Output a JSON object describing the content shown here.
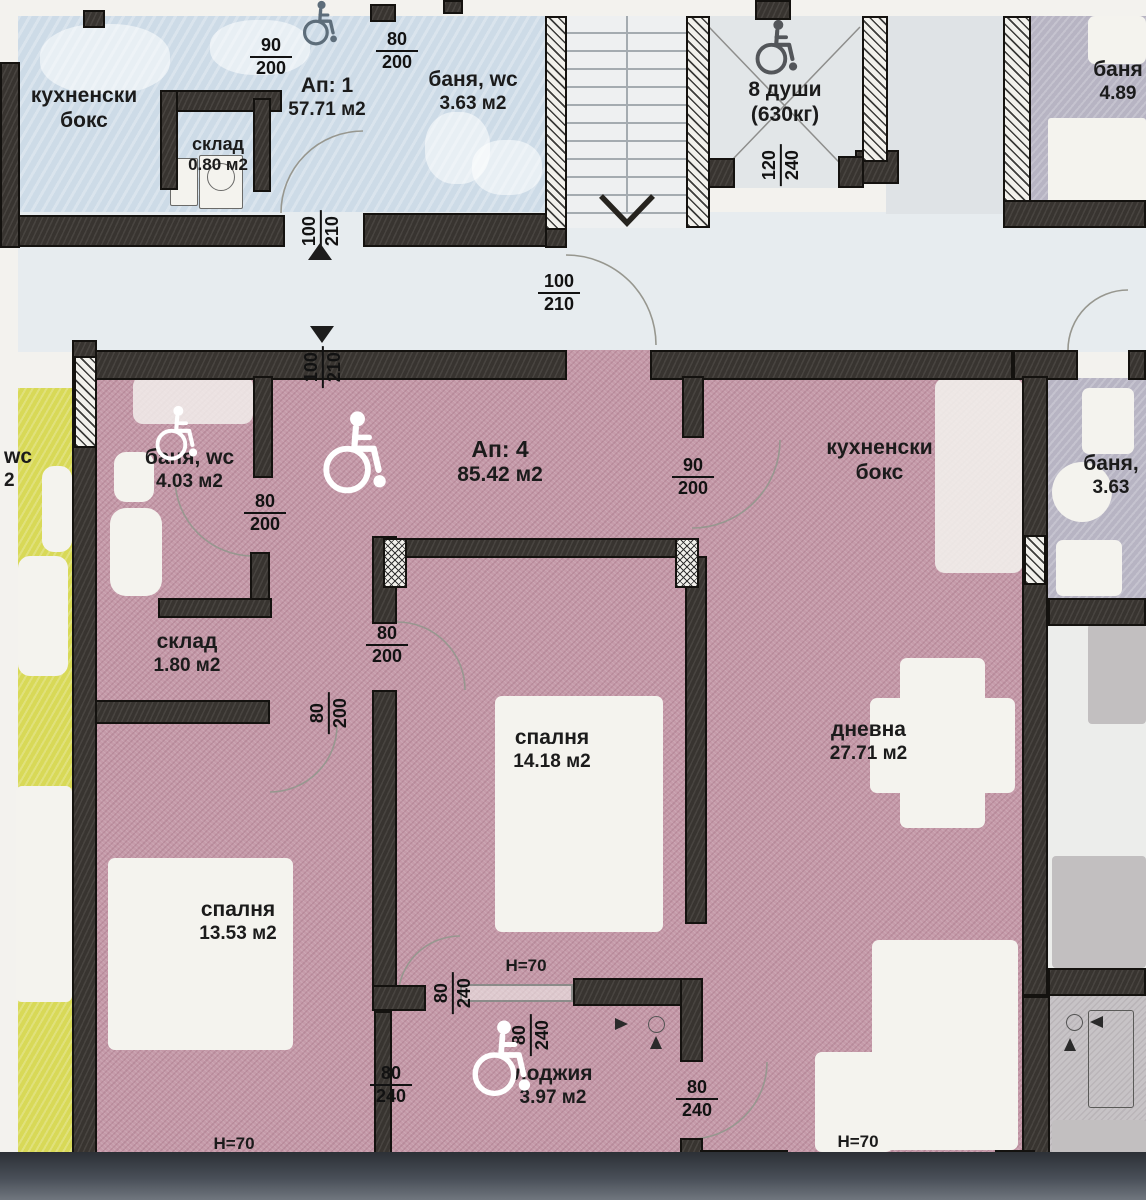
{
  "colors": {
    "apartment_pink": "#c59aa9",
    "walls_dark": "#33302c",
    "upper_blue": "#cddbe7",
    "adjacent_yellow": "#d8d957",
    "corridor_gray": "#e7ecef"
  },
  "upper": {
    "kitchen_label": "кухненски бокс",
    "ap1_title": "Ап: 1",
    "ap1_area": "57.71 м2",
    "storage_label": "склад",
    "storage_area": "0.80 м2",
    "bath_label": "баня, wc",
    "bath_area": "3.63 м2",
    "elevator_capacity": "8 души",
    "elevator_weight": "(630кг)",
    "bath_right_label": "баня",
    "bath_right_area": "4.89"
  },
  "ap4": {
    "title": "Ап: 4",
    "area": "85.42 м2",
    "bath_label": "баня, wc",
    "bath_area": "4.03 м2",
    "storage_label": "склад",
    "storage_area": "1.80 м2",
    "kitchen_label": "кухненски бокс",
    "bedroom1_label": "спалня",
    "bedroom1_area": "14.18 м2",
    "bedroom2_label": "спалня",
    "bedroom2_area": "13.53 м2",
    "living_label": "дневна",
    "living_area": "27.71 м2",
    "loggia_label": "лоджия",
    "loggia_area": "3.97 м2"
  },
  "right": {
    "bath_label": "баня,",
    "bath_area": "3.63"
  },
  "left": {
    "partial_wc": "wc",
    "partial_area": "2"
  },
  "annotations": {
    "parapet_height": "H=70"
  },
  "dims": {
    "d0": {
      "num": "90",
      "den": "200"
    },
    "d1": {
      "num": "80",
      "den": "200"
    },
    "d2": {
      "num": "100",
      "den": "210"
    },
    "d3": {
      "num": "100",
      "den": "210"
    },
    "d4": {
      "num": "100",
      "den": "210"
    },
    "d5": {
      "num": "120",
      "den": "240"
    },
    "d6": {
      "num": "80",
      "den": "200"
    },
    "d7": {
      "num": "90",
      "den": "200"
    },
    "d8": {
      "num": "80",
      "den": "200"
    },
    "d9": {
      "num": "80",
      "den": "200"
    },
    "d10": {
      "num": "80",
      "den": "240"
    },
    "d11": {
      "num": "80",
      "den": "240"
    },
    "d12": {
      "num": "80",
      "den": "240"
    },
    "d13": {
      "num": "80",
      "den": "240"
    }
  },
  "icons": {
    "wheelchair": "wheelchair-symbol",
    "up_arrow": "triangle-up",
    "down_arrow": "triangle-down",
    "stairs_direction": "chevron-down"
  }
}
